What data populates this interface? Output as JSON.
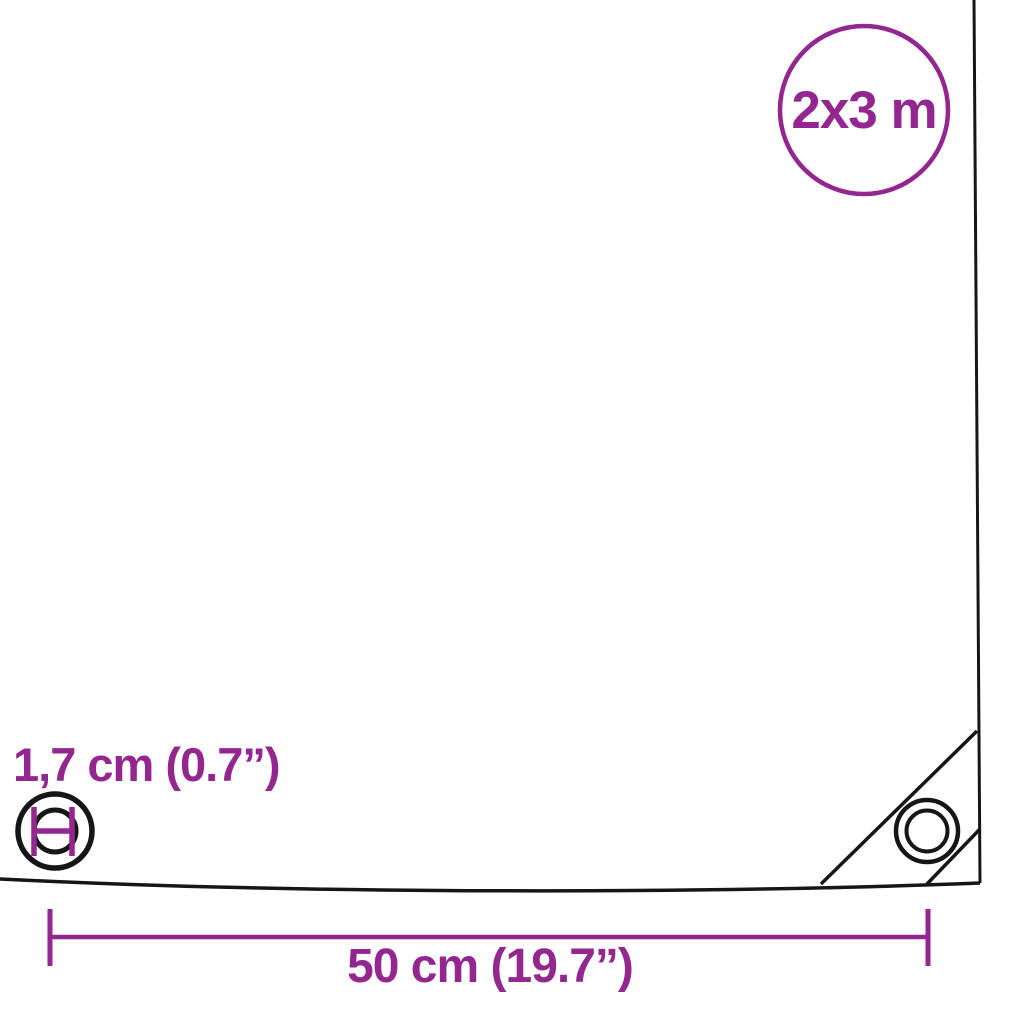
{
  "image": {
    "type": "product-dimension-diagram",
    "subject": "tarpaulin-sheet-with-grommets"
  },
  "colors": {
    "accent": "#93278F",
    "line": "#161616",
    "background": "#ffffff"
  },
  "size_badge": {
    "label": "2x3 m"
  },
  "grommet_detail": {
    "label": "1,7 cm (0.7”)"
  },
  "width_dimension": {
    "label": "50 cm (19.7”)"
  }
}
